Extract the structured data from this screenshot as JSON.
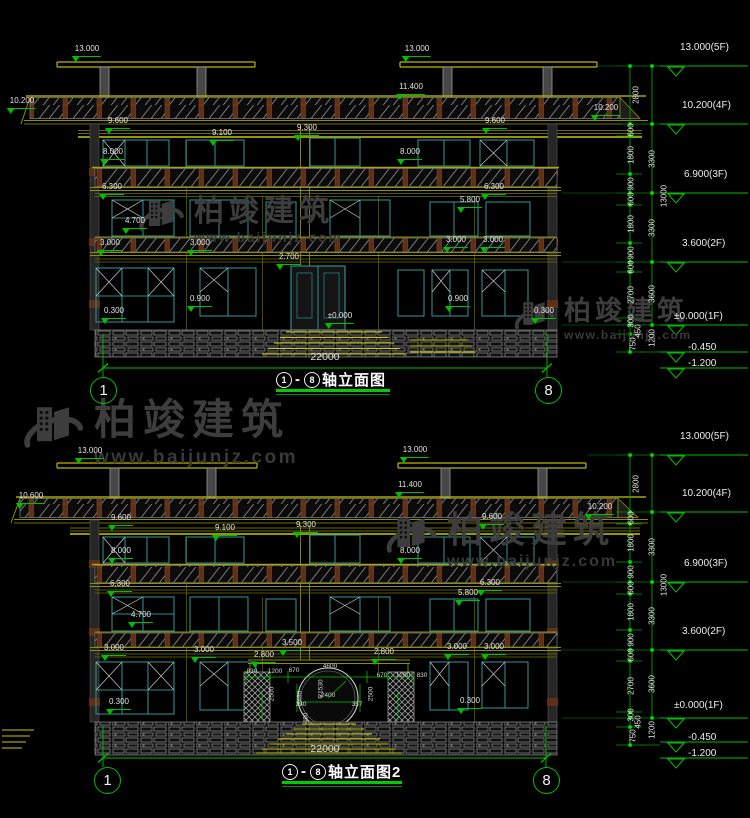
{
  "watermark": {
    "brand": "柏竣建筑",
    "url": "www.baijunjz.com"
  },
  "drawings": [
    {
      "title": {
        "from": "1",
        "dash": "-",
        "to": "8",
        "name": "轴立面图"
      },
      "axis_left": "1",
      "axis_right": "8",
      "labels": [
        {
          "t": "13.000",
          "x": 87,
          "y": 45,
          "k": "m"
        },
        {
          "t": "13.000",
          "x": 417,
          "y": 45,
          "k": "m"
        },
        {
          "t": "11.400",
          "x": 411,
          "y": 83,
          "k": "m"
        },
        {
          "t": "10.200",
          "x": 22,
          "y": 97,
          "k": "m"
        },
        {
          "t": "10.200",
          "x": 606,
          "y": 104,
          "k": "m"
        },
        {
          "t": "9.600",
          "x": 118,
          "y": 117,
          "k": "m"
        },
        {
          "t": "9.600",
          "x": 495,
          "y": 117,
          "k": "m"
        },
        {
          "t": "9.100",
          "x": 222,
          "y": 129,
          "k": "m"
        },
        {
          "t": "9.300",
          "x": 307,
          "y": 124,
          "k": "m"
        },
        {
          "t": "8.000",
          "x": 113,
          "y": 148,
          "k": "m"
        },
        {
          "t": "8.000",
          "x": 410,
          "y": 148,
          "k": "m"
        },
        {
          "t": "6.300",
          "x": 112,
          "y": 183,
          "k": "m"
        },
        {
          "t": "6.300",
          "x": 494,
          "y": 183,
          "k": "m"
        },
        {
          "t": "5.800",
          "x": 470,
          "y": 196,
          "k": "m"
        },
        {
          "t": "4.700",
          "x": 135,
          "y": 217,
          "k": "m"
        },
        {
          "t": "3.000",
          "x": 110,
          "y": 239,
          "k": "m"
        },
        {
          "t": "3.000",
          "x": 200,
          "y": 239,
          "k": "m"
        },
        {
          "t": "2.700",
          "x": 289,
          "y": 253,
          "k": "m"
        },
        {
          "t": "3.000",
          "x": 456,
          "y": 236,
          "k": "m"
        },
        {
          "t": "3.000",
          "x": 493,
          "y": 236,
          "k": "m"
        },
        {
          "t": "0.900",
          "x": 200,
          "y": 295,
          "k": "m"
        },
        {
          "t": "0.900",
          "x": 458,
          "y": 295,
          "k": "m"
        },
        {
          "t": "0.300",
          "x": 114,
          "y": 307,
          "k": "m"
        },
        {
          "t": "0.300",
          "x": 544,
          "y": 307,
          "k": "m"
        },
        {
          "t": "±0.000",
          "x": 340,
          "y": 312,
          "k": "m"
        },
        {
          "t": "22000",
          "x": 325,
          "y": 352,
          "k": "t big"
        },
        {
          "t": "2800",
          "x": 637,
          "y": 95,
          "k": "r"
        },
        {
          "t": "600",
          "x": 632,
          "y": 130,
          "k": "r"
        },
        {
          "t": "1800",
          "x": 632,
          "y": 155,
          "k": "r"
        },
        {
          "t": "900",
          "x": 632,
          "y": 184,
          "k": "r"
        },
        {
          "t": "3300",
          "x": 653,
          "y": 159,
          "k": "r"
        },
        {
          "t": "600",
          "x": 632,
          "y": 199,
          "k": "r"
        },
        {
          "t": "1800",
          "x": 632,
          "y": 224,
          "k": "r"
        },
        {
          "t": "900",
          "x": 632,
          "y": 253,
          "k": "r"
        },
        {
          "t": "3300",
          "x": 653,
          "y": 228,
          "k": "r"
        },
        {
          "t": "600",
          "x": 632,
          "y": 267,
          "k": "r"
        },
        {
          "t": "2700",
          "x": 632,
          "y": 295,
          "k": "r"
        },
        {
          "t": "300",
          "x": 632,
          "y": 321,
          "k": "r"
        },
        {
          "t": "3600",
          "x": 653,
          "y": 294,
          "k": "r"
        },
        {
          "t": "450",
          "x": 639,
          "y": 331,
          "k": "r"
        },
        {
          "t": "750",
          "x": 634,
          "y": 344,
          "k": "r"
        },
        {
          "t": "1200",
          "x": 653,
          "y": 338,
          "k": "r"
        },
        {
          "t": "13000",
          "x": 665,
          "y": 196,
          "k": "r"
        },
        {
          "t": "13.000(5F)",
          "x": 680,
          "y": 42,
          "k": "lv"
        },
        {
          "t": "10.200(4F)",
          "x": 682,
          "y": 100,
          "k": "lv"
        },
        {
          "t": "6.900(3F)",
          "x": 684,
          "y": 169,
          "k": "lv"
        },
        {
          "t": "3.600(2F)",
          "x": 682,
          "y": 238,
          "k": "lv"
        },
        {
          "t": "±0.000(1F)",
          "x": 674,
          "y": 311,
          "k": "lv"
        },
        {
          "t": "-0.450",
          "x": 688,
          "y": 342,
          "k": "lv"
        },
        {
          "t": "-1.200",
          "x": 688,
          "y": 358,
          "k": "lv"
        }
      ]
    },
    {
      "title": {
        "from": "1",
        "dash": "-",
        "to": "8",
        "name": "轴立面图2"
      },
      "axis_left": "1",
      "axis_right": "8",
      "labels": [
        {
          "t": "13.000",
          "x": 90,
          "y": 447,
          "k": "m"
        },
        {
          "t": "13.000",
          "x": 415,
          "y": 446,
          "k": "m"
        },
        {
          "t": "11.400",
          "x": 410,
          "y": 481,
          "k": "m"
        },
        {
          "t": "10.600",
          "x": 31,
          "y": 492,
          "k": "m"
        },
        {
          "t": "10.200",
          "x": 600,
          "y": 503,
          "k": "m"
        },
        {
          "t": "9.600",
          "x": 121,
          "y": 514,
          "k": "m"
        },
        {
          "t": "9.600",
          "x": 492,
          "y": 513,
          "k": "m"
        },
        {
          "t": "9.100",
          "x": 225,
          "y": 524,
          "k": "m"
        },
        {
          "t": "9.300",
          "x": 306,
          "y": 521,
          "k": "m"
        },
        {
          "t": "8.000",
          "x": 121,
          "y": 547,
          "k": "m"
        },
        {
          "t": "8.000",
          "x": 410,
          "y": 547,
          "k": "m"
        },
        {
          "t": "6.300",
          "x": 120,
          "y": 580,
          "k": "m"
        },
        {
          "t": "6.300",
          "x": 490,
          "y": 579,
          "k": "m"
        },
        {
          "t": "5.800",
          "x": 468,
          "y": 589,
          "k": "m"
        },
        {
          "t": "4.700",
          "x": 141,
          "y": 611,
          "k": "m"
        },
        {
          "t": "3.000",
          "x": 114,
          "y": 644,
          "k": "m"
        },
        {
          "t": "3.000",
          "x": 204,
          "y": 646,
          "k": "m"
        },
        {
          "t": "3.500",
          "x": 292,
          "y": 639,
          "k": "m"
        },
        {
          "t": "2.800",
          "x": 264,
          "y": 651,
          "k": "m"
        },
        {
          "t": "2.800",
          "x": 384,
          "y": 648,
          "k": "m"
        },
        {
          "t": "3.000",
          "x": 457,
          "y": 643,
          "k": "m"
        },
        {
          "t": "3.000",
          "x": 494,
          "y": 643,
          "k": "m"
        },
        {
          "t": "0.300",
          "x": 119,
          "y": 698,
          "k": "m"
        },
        {
          "t": "0.300",
          "x": 470,
          "y": 697,
          "k": "m"
        },
        {
          "t": "22000",
          "x": 325,
          "y": 744,
          "k": "t big"
        },
        {
          "t": "830",
          "x": 252,
          "y": 668,
          "k": "s"
        },
        {
          "t": "1200",
          "x": 275,
          "y": 668,
          "k": "s"
        },
        {
          "t": "670",
          "x": 294,
          "y": 667,
          "k": "s"
        },
        {
          "t": "4600",
          "x": 330,
          "y": 663,
          "k": "s"
        },
        {
          "t": "R1530",
          "x": 321,
          "y": 689,
          "k": "rs"
        },
        {
          "t": "2480",
          "x": 300,
          "y": 698,
          "k": "rs"
        },
        {
          "t": "2400",
          "x": 328,
          "y": 692,
          "k": "s"
        },
        {
          "t": "330",
          "x": 301,
          "y": 701,
          "k": "s"
        },
        {
          "t": "357",
          "x": 357,
          "y": 701,
          "k": "s"
        },
        {
          "t": "2500",
          "x": 272,
          "y": 694,
          "k": "rs"
        },
        {
          "t": "2500",
          "x": 371,
          "y": 694,
          "k": "rs"
        },
        {
          "t": "480",
          "x": 306,
          "y": 718,
          "k": "rs"
        },
        {
          "t": "670",
          "x": 382,
          "y": 672,
          "k": "s"
        },
        {
          "t": "1200",
          "x": 403,
          "y": 672,
          "k": "s"
        },
        {
          "t": "830",
          "x": 422,
          "y": 672,
          "k": "s"
        },
        {
          "t": "2800",
          "x": 637,
          "y": 484,
          "k": "r"
        },
        {
          "t": "600",
          "x": 632,
          "y": 518,
          "k": "r"
        },
        {
          "t": "1800",
          "x": 632,
          "y": 543,
          "k": "r"
        },
        {
          "t": "900",
          "x": 632,
          "y": 572,
          "k": "r"
        },
        {
          "t": "3300",
          "x": 653,
          "y": 547,
          "k": "r"
        },
        {
          "t": "600",
          "x": 632,
          "y": 588,
          "k": "r"
        },
        {
          "t": "1800",
          "x": 632,
          "y": 612,
          "k": "r"
        },
        {
          "t": "900",
          "x": 632,
          "y": 640,
          "k": "r"
        },
        {
          "t": "3300",
          "x": 653,
          "y": 616,
          "k": "r"
        },
        {
          "t": "600",
          "x": 632,
          "y": 655,
          "k": "r"
        },
        {
          "t": "2700",
          "x": 632,
          "y": 686,
          "k": "r"
        },
        {
          "t": "300",
          "x": 632,
          "y": 715,
          "k": "r"
        },
        {
          "t": "3600",
          "x": 653,
          "y": 684,
          "k": "r"
        },
        {
          "t": "450",
          "x": 639,
          "y": 722,
          "k": "r"
        },
        {
          "t": "750",
          "x": 634,
          "y": 736,
          "k": "r"
        },
        {
          "t": "1200",
          "x": 653,
          "y": 730,
          "k": "r"
        },
        {
          "t": "13000",
          "x": 665,
          "y": 585,
          "k": "r"
        },
        {
          "t": "13.000(5F)",
          "x": 680,
          "y": 431,
          "k": "lv"
        },
        {
          "t": "10.200(4F)",
          "x": 682,
          "y": 488,
          "k": "lv"
        },
        {
          "t": "6.900(3F)",
          "x": 684,
          "y": 558,
          "k": "lv"
        },
        {
          "t": "3.600(2F)",
          "x": 682,
          "y": 626,
          "k": "lv"
        },
        {
          "t": "±0.000(1F)",
          "x": 674,
          "y": 700,
          "k": "lv"
        },
        {
          "t": "-0.450",
          "x": 688,
          "y": 732,
          "k": "lv"
        },
        {
          "t": "-1.200",
          "x": 688,
          "y": 748,
          "k": "lv"
        }
      ]
    }
  ]
}
